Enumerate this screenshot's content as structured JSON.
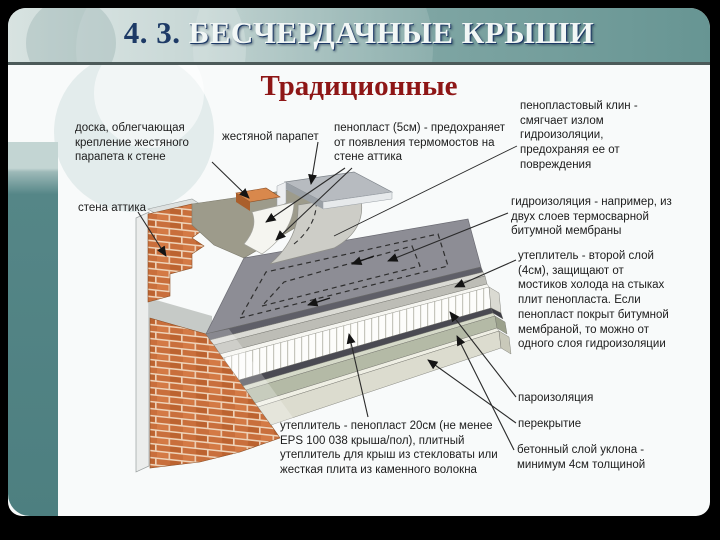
{
  "theme": {
    "frame_color": "#000000",
    "header_teal_left": "#d8e3e1",
    "header_teal_right": "#679593",
    "sidebar_teal": "#558687",
    "title_navy": "#1d3a66",
    "title_light": "#f2f7f6",
    "subtitle_red": "#8e1616",
    "label_text": "#1c1c1c",
    "brick_orange": "#c96f3c",
    "membrane_gray": "#8d8d95",
    "concrete_green": "#b4baa6",
    "foam_white": "#ffffff"
  },
  "slide": {
    "title_prefix": "4. 3.",
    "title": "БЕСЧЕРДАЧНЫЕ КРЫШИ",
    "subtitle": "Традиционные"
  },
  "diagram": {
    "labels": [
      {
        "id": "board",
        "text": "доска, облегчающая крепление жестяного парапета к стене"
      },
      {
        "id": "tin-parapet",
        "text": "жестяной парапет"
      },
      {
        "id": "foam-5cm",
        "text": "пенопласт (5см) - предохраняет от появления термомостов на стене аттика"
      },
      {
        "id": "attic-wall",
        "text": "стена аттика"
      },
      {
        "id": "foam-wedge",
        "text": "пенопластовый клин - смягчает излом гидроизоляции, предохраняя ее от повреждения"
      },
      {
        "id": "waterproofing",
        "text": "гидроизоляция - например, из двух слоев термосварной битумной мембраны"
      },
      {
        "id": "insulation-second-layer",
        "text": "утеплитель - второй слой (4см), защищают от мостиков холода на стыках плит пенопласта. Если пенопласт покрыт битумной мембраной, то можно от одного слоя гидроизоляции"
      },
      {
        "id": "vapor-barrier",
        "text": "пароизоляция"
      },
      {
        "id": "floor-slab",
        "text": "перекрытие"
      },
      {
        "id": "concrete-slope",
        "text": "бетонный слой уклона - минимум 4см толщиной"
      },
      {
        "id": "insulation-20cm",
        "text": "утеплитель - пенопласт 20см (не менее EPS 100 038 крыша/пол), плитный утеплитель для крыш из стекловаты или жесткая плита из каменного волокна"
      }
    ]
  }
}
